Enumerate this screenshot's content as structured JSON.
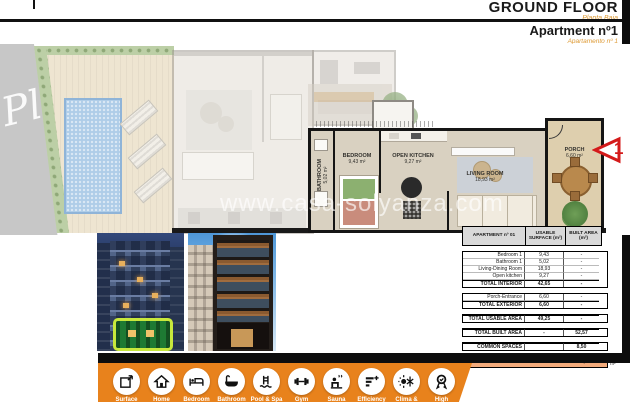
{
  "header": {
    "title": "GROUND FLOOR",
    "subtitle": "Planta Baja",
    "apartment_title": "Apartment nº1",
    "apartment_subtitle": "Apartamento nº 1"
  },
  "watermarks": {
    "site": "www.casa-solyanza.com",
    "corner_script": "Pl"
  },
  "plan": {
    "rooms": [
      {
        "label": "BATHROOM",
        "area": "5,02 m²"
      },
      {
        "label": "BEDROOM",
        "area": "9,43 m²"
      },
      {
        "label": "OPEN KITCHEN",
        "area": "9,27 m²"
      },
      {
        "label": "LIVING ROOM",
        "area": "18,93 m²"
      },
      {
        "label": "PORCH",
        "area": "6,60 m²"
      }
    ],
    "entrance_marker": "1"
  },
  "table": {
    "headers": [
      "APARTMENT nº 01",
      "USABLE SURFACE (m²)",
      "BUILT AREA (m²)"
    ],
    "groups": [
      [
        {
          "label": "Bedroom 1",
          "usable": "9,43",
          "built": "-"
        },
        {
          "label": "Bathroom 1",
          "usable": "5,02",
          "built": "-"
        },
        {
          "label": "Living-Dining Room",
          "usable": "18,93",
          "built": "-"
        },
        {
          "label": "Open kitchen",
          "usable": "9,27",
          "built": "-"
        },
        {
          "label": "TOTAL INTERIOR",
          "usable": "42,65",
          "built": "-",
          "bold": true
        }
      ],
      [
        {
          "label": "Porch-Entrance",
          "usable": "6,60",
          "built": "-"
        },
        {
          "label": "TOTAL EXTERIOR",
          "usable": "6,60",
          "built": "-",
          "bold": true
        }
      ],
      [
        {
          "label": "TOTAL USABLE AREA",
          "usable": "49,25",
          "built": "-",
          "bold": true
        }
      ],
      [
        {
          "label": "TOTAL BUILT AREA",
          "usable": "-",
          "built": "52,57",
          "bold": true
        }
      ],
      [
        {
          "label": "COMMON SPACES",
          "usable": "",
          "built": "8,50",
          "bold": true
        }
      ]
    ],
    "total_row": {
      "label": "TOTAL AREA",
      "value": "61,07",
      "unit": "m²"
    }
  },
  "banner": {
    "icons": [
      {
        "name": "surface-icon",
        "label": "Surface"
      },
      {
        "name": "home-icon",
        "label": "Home"
      },
      {
        "name": "bed-icon",
        "label": "Bedroom"
      },
      {
        "name": "bath-icon",
        "label": "Bathroom"
      },
      {
        "name": "pool-icon",
        "label": "Pool & Spa"
      },
      {
        "name": "gym-icon",
        "label": "Gym"
      },
      {
        "name": "sauna-icon",
        "label": "Sauna"
      },
      {
        "name": "efficiency-icon",
        "label": "Efficiency"
      },
      {
        "name": "clima-icon",
        "label": "Clima &"
      },
      {
        "name": "quality-icon",
        "label": "High"
      }
    ]
  },
  "colors": {
    "accent_orange": "#e8821c",
    "subtitle_orange": "#dd9933",
    "table_total_fill": "#f2aa7b",
    "marker_red": "#d41a1a",
    "highlight_green": "#c8e83c"
  }
}
